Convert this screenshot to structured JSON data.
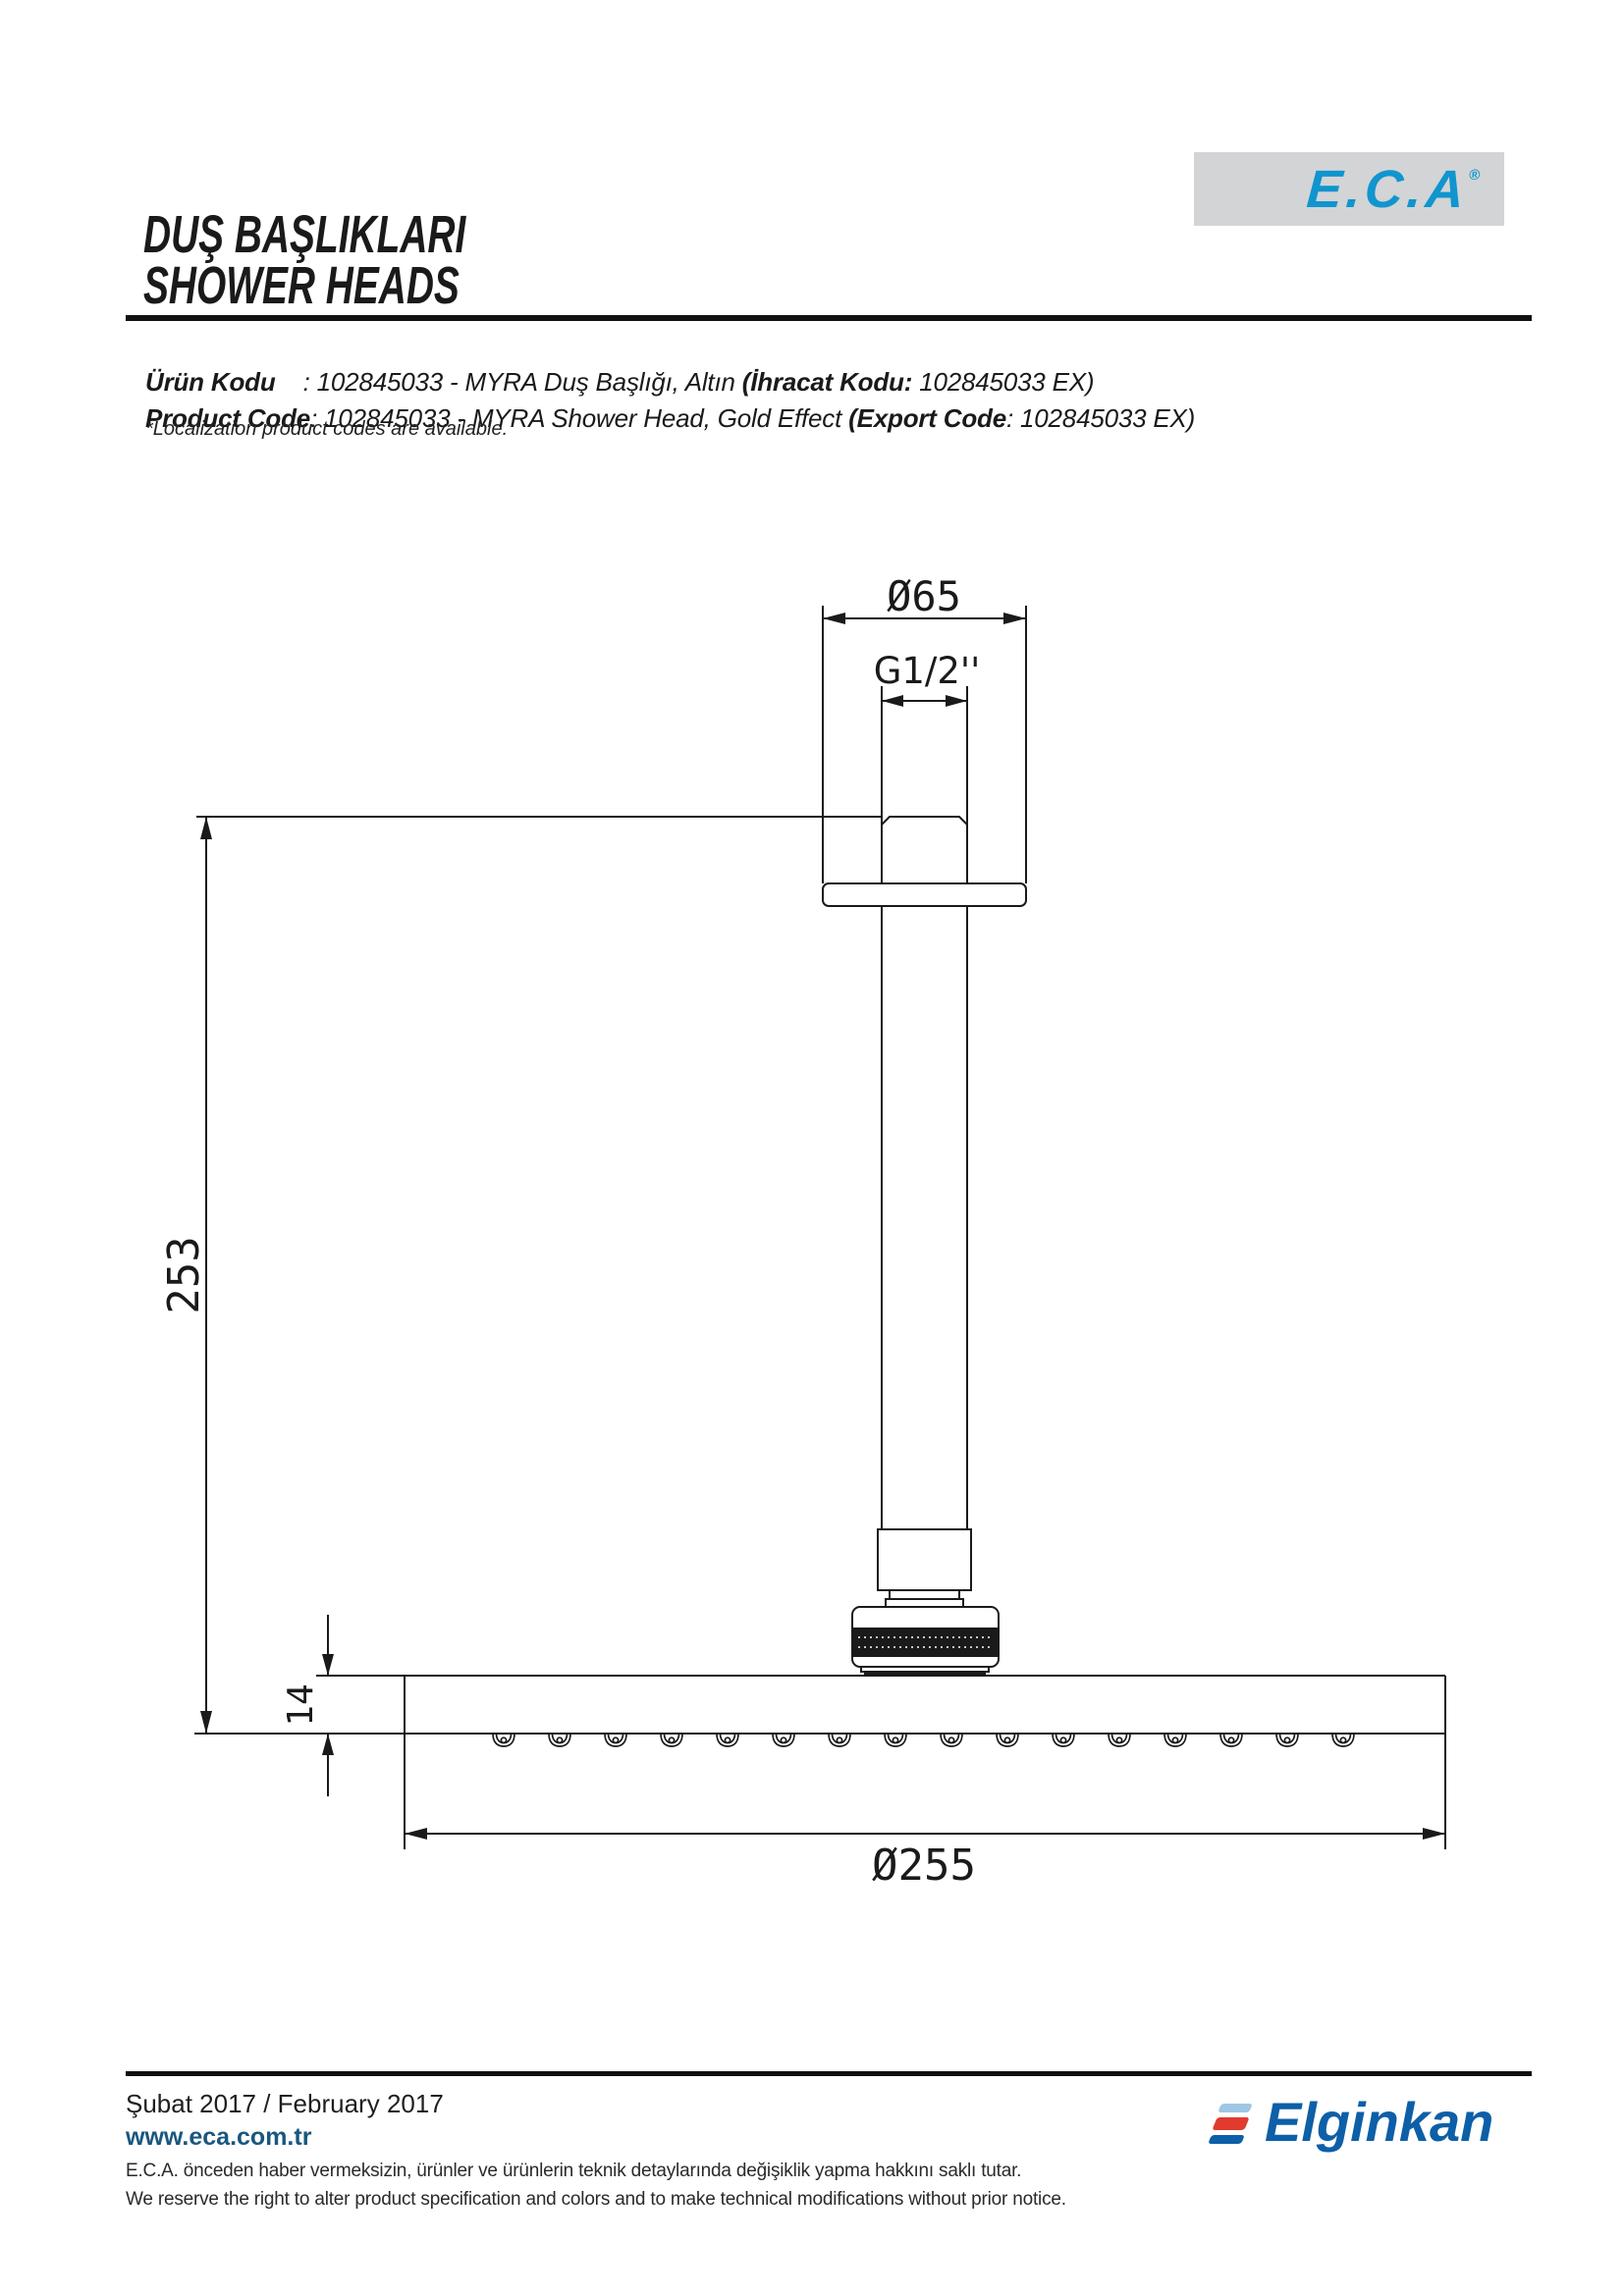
{
  "header": {
    "title_tr": "DUŞ BAŞLIKLARI",
    "title_en": "SHOWER HEADS"
  },
  "brand": {
    "logo_text": "E.C.A",
    "registered_mark": "®",
    "logo_color": "#1095ce",
    "box_color": "#d2d4d6"
  },
  "product_code": {
    "tr_label": "Ürün Kodu",
    "tr_mid": "    : 102845033 - MYRA Duş Başlığı, Altın ",
    "tr_export_label": "(İhracat Kodu:",
    "tr_tail": " 102845033 EX)",
    "en_label": "Product Code",
    "en_mid": ": 102845033 - MYRA Shower Head, Gold Effect ",
    "en_export_label": "(Export Code",
    "en_tail": ": 102845033 EX)",
    "note": "*Localization product codes are available."
  },
  "drawing": {
    "dim_top_diameter": "Ø65",
    "dim_thread": "G1/2''",
    "dim_height": "253",
    "dim_head_thickness": "14",
    "dim_head_diameter": "Ø255",
    "line_color": "#1a1a1a"
  },
  "footer": {
    "date": "Şubat 2017 / February 2017",
    "website": "www.eca.com.tr",
    "website_color": "#19577e",
    "disclaimer_tr": "E.C.A. önceden haber vermeksizin, ürünler ve ürünlerin teknik detaylarında değişiklik yapma hakkını saklı tutar.",
    "disclaimer_en": "We reserve the right to alter product specification and colors and to make technical modifications without prior notice.",
    "company_logo_text": "Elginkan",
    "company_logo_colors": {
      "blue": "#0d5fa7",
      "red": "#e23a2e",
      "light_blue": "#9ec7e4"
    }
  }
}
